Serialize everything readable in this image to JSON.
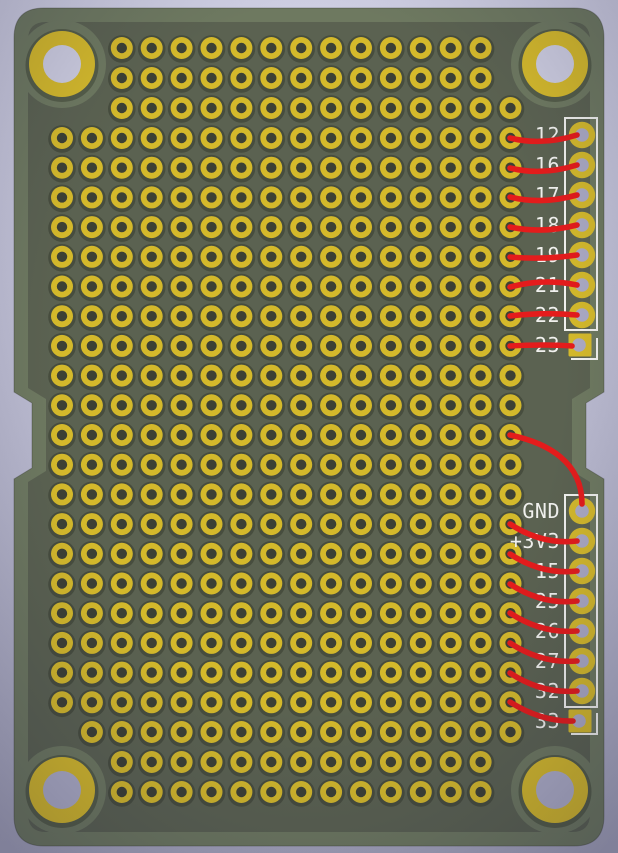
{
  "pcb": {
    "viewport": {
      "width": 618,
      "height": 853
    },
    "palette": {
      "bg_top": "#cecee2",
      "bg_bottom": "#a6a6bd",
      "vignette": "rgba(25,25,55,0.27)",
      "board_base": "#6e7960",
      "zone": "#5b6251",
      "pad_shadow": "rgba(30,35,22,0.32)",
      "pad_yellow": "#d4b92b",
      "hole_dark": "#3c4035",
      "through_hole": "#abaac4",
      "mount_inner_top": "#cdcde0",
      "mount_inner_bottom": "#aeaec7",
      "silkscreen": "#f1f1ee",
      "ratsnest_red": "#e41c1c"
    },
    "board": {
      "x": 14,
      "y": 8,
      "width": 590,
      "height": 838,
      "corner_radius": 30,
      "zone_inset": 14,
      "notch_top_y": 392,
      "notch_bottom_y": 479,
      "notch_depth": 18
    },
    "grid": {
      "origin_x": 62,
      "spacing_x": 29.9,
      "pad_radius": 11,
      "hole_radius": 5.2,
      "shadow_radius": 13.8,
      "rows": [
        {
          "y": 48,
          "c0": 2,
          "c1": 14
        },
        {
          "y": 78,
          "c0": 2,
          "c1": 14
        },
        {
          "y": 108,
          "c0": 2,
          "c1": 15
        },
        {
          "y": 138,
          "c0": 0,
          "c1": 15
        },
        {
          "y": 167.7,
          "c0": 0,
          "c1": 15
        },
        {
          "y": 197.4,
          "c0": 0,
          "c1": 15
        },
        {
          "y": 227.1,
          "c0": 0,
          "c1": 15
        },
        {
          "y": 256.8,
          "c0": 0,
          "c1": 15
        },
        {
          "y": 286.5,
          "c0": 0,
          "c1": 15
        },
        {
          "y": 316.2,
          "c0": 0,
          "c1": 15
        },
        {
          "y": 345.9,
          "c0": 0,
          "c1": 15
        },
        {
          "y": 375.6,
          "c0": 0,
          "c1": 15
        },
        {
          "y": 405.3,
          "c0": 0,
          "c1": 15
        },
        {
          "y": 435,
          "c0": 0,
          "c1": 15
        },
        {
          "y": 464.7,
          "c0": 0,
          "c1": 15
        },
        {
          "y": 494.4,
          "c0": 0,
          "c1": 15
        },
        {
          "y": 524.1,
          "c0": 0,
          "c1": 15
        },
        {
          "y": 553.8,
          "c0": 0,
          "c1": 15
        },
        {
          "y": 583.5,
          "c0": 0,
          "c1": 15
        },
        {
          "y": 613.2,
          "c0": 0,
          "c1": 15
        },
        {
          "y": 642.9,
          "c0": 0,
          "c1": 15
        },
        {
          "y": 672.6,
          "c0": 0,
          "c1": 15
        },
        {
          "y": 702.3,
          "c0": 0,
          "c1": 15
        },
        {
          "y": 732,
          "c0": 1,
          "c1": 15
        },
        {
          "y": 762,
          "c0": 2,
          "c1": 14
        },
        {
          "y": 792,
          "c0": 2,
          "c1": 14
        }
      ]
    },
    "mounting_holes": {
      "ring_radius": 33,
      "hole_radius": 19,
      "clearance_radius": 44,
      "shadow_radius": 36.5,
      "positions": [
        {
          "x": 62,
          "y": 64,
          "inner": "top"
        },
        {
          "x": 555,
          "y": 64,
          "inner": "top"
        },
        {
          "x": 62,
          "y": 790,
          "inner": "bottom"
        },
        {
          "x": 555,
          "y": 790,
          "inner": "bottom"
        }
      ]
    },
    "headers": [
      {
        "side": "top",
        "silk_box": {
          "x": 565,
          "y": 118,
          "w": 32,
          "h": 212
        },
        "pin1_mark": "597,338 597,359 571,359",
        "pad_x": 582,
        "first_pad_y": 135,
        "pad_pitch": 30,
        "label_right_x": 560,
        "pins": [
          {
            "label": "12",
            "pad": "round"
          },
          {
            "label": "16",
            "pad": "round"
          },
          {
            "label": "17",
            "pad": "round"
          },
          {
            "label": "18",
            "pad": "round"
          },
          {
            "label": "19",
            "pad": "round"
          },
          {
            "label": "21",
            "pad": "round"
          },
          {
            "label": "22",
            "pad": "round"
          },
          {
            "label": "23",
            "pad": "square"
          }
        ]
      },
      {
        "side": "bottom",
        "silk_box": {
          "x": 565,
          "y": 495,
          "w": 32,
          "h": 212
        },
        "pin1_mark": "597,713 597,734 571,734",
        "pad_x": 582,
        "first_pad_y": 511,
        "pad_pitch": 30,
        "label_right_x": 560,
        "pins": [
          {
            "label": "GND",
            "pad": "round"
          },
          {
            "label": "+3V3",
            "pad": "round"
          },
          {
            "label": "15",
            "pad": "round"
          },
          {
            "label": "25",
            "pad": "round"
          },
          {
            "label": "26",
            "pad": "round"
          },
          {
            "label": "27",
            "pad": "round"
          },
          {
            "label": "32",
            "pad": "round"
          },
          {
            "label": "33",
            "pad": "square"
          }
        ]
      }
    ],
    "ratsnest": [
      {
        "net": "12",
        "path": "M 510 138 Q 542 146 577 135"
      },
      {
        "net": "16",
        "path": "M 510 168 Q 542 176 577 165"
      },
      {
        "net": "17",
        "path": "M 510 197 Q 542 205 577 195"
      },
      {
        "net": "18",
        "path": "M 510 227 Q 542 234 577 225"
      },
      {
        "net": "19",
        "path": "M 510 257 Q 544 260 577 255"
      },
      {
        "net": "21",
        "path": "M 510 287 Q 544 278 577 285"
      },
      {
        "net": "22",
        "path": "M 510 316 Q 544 312 577 315"
      },
      {
        "net": "23",
        "path": "M 510 346 Q 544 344 572 346"
      },
      {
        "net": "GND",
        "path": "M 510 435 C 548 443 582 462 582 504"
      },
      {
        "net": "+3V3",
        "path": "M 510 524 Q 542 545 577 541"
      },
      {
        "net": "15",
        "path": "M 510 554 Q 542 575 577 571"
      },
      {
        "net": "25",
        "path": "M 510 584 Q 542 605 577 601"
      },
      {
        "net": "26",
        "path": "M 510 613 Q 542 634 577 631"
      },
      {
        "net": "27",
        "path": "M 510 643 Q 542 664 577 661"
      },
      {
        "net": "32",
        "path": "M 510 673 Q 542 694 577 691"
      },
      {
        "net": "33",
        "path": "M 510 702 Q 542 722 573 721"
      }
    ]
  }
}
